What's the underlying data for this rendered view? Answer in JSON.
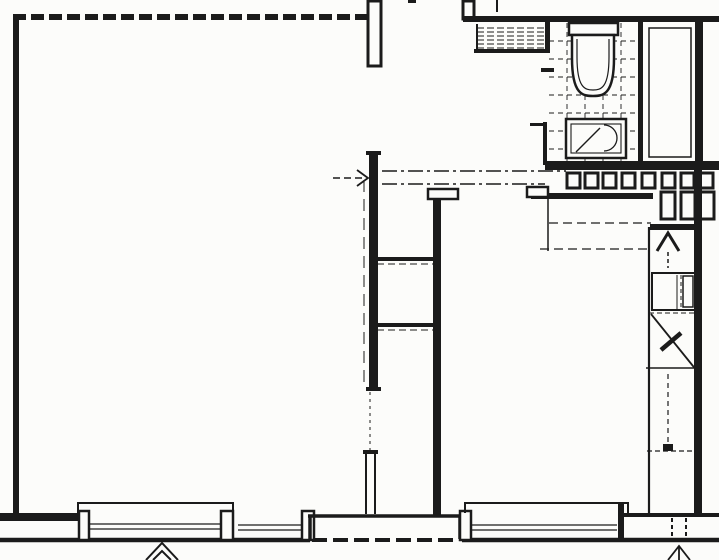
{
  "meta": {
    "width": 719,
    "height": 560,
    "kind": "architectural-floor-plan"
  },
  "colors": {
    "ink": "#1b1b1b",
    "paper": "#fcfcfa"
  },
  "floorplan": {
    "primitives": [
      {
        "name": "bathroom-tile-floor",
        "kind": "grid",
        "x": 549,
        "y": 23,
        "w": 89,
        "h": 141,
        "cell": 18,
        "sw": 0.9,
        "dash": [
          5,
          4
        ]
      },
      {
        "name": "vent-hatch-band",
        "kind": "hatch",
        "x": 477,
        "y": 24,
        "w": 70,
        "h": 27,
        "step": 4,
        "sw": 1.1,
        "dash": [
          7,
          3
        ]
      },
      {
        "name": "vent-hatch-bottom-wall",
        "kind": "line",
        "x1": 474,
        "y1": 51,
        "x2": 550,
        "y2": 51,
        "sw": 4
      },
      {
        "name": "vent-hatch-left-edge",
        "kind": "line",
        "x1": 477,
        "y1": 24,
        "x2": 477,
        "y2": 51,
        "sw": 2
      },
      {
        "name": "wall-left-outer",
        "kind": "rect",
        "x": 13,
        "y": 14,
        "w": 6,
        "h": 501
      },
      {
        "name": "wall-top-main-room",
        "kind": "line",
        "x1": 13,
        "y1": 17,
        "x2": 368,
        "y2": 17,
        "sw": 6,
        "dash": [
          13,
          5
        ]
      },
      {
        "name": "chimney-recess-left",
        "kind": "box",
        "x": 368,
        "y": 1,
        "w": 13,
        "h": 65,
        "sw": 3
      },
      {
        "name": "chimney-stub-right",
        "kind": "box",
        "x": 463,
        "y": 1,
        "w": 11,
        "h": 18,
        "sw": 3
      },
      {
        "name": "wall-top-right",
        "kind": "rect",
        "x": 463,
        "y": 16,
        "w": 256,
        "h": 6
      },
      {
        "name": "top-edge-tick",
        "kind": "rect",
        "x": 408,
        "y": 0,
        "w": 8,
        "h": 3
      },
      {
        "name": "hatch-top-tick",
        "kind": "line",
        "x1": 497,
        "y1": 0,
        "x2": 497,
        "y2": 12,
        "sw": 2
      },
      {
        "name": "bathroom-wall-left-upper",
        "kind": "rect",
        "x": 545,
        "y": 22,
        "w": 5,
        "h": 29
      },
      {
        "name": "bathroom-door-jamb",
        "kind": "rect",
        "x": 541,
        "y": 68,
        "w": 13,
        "h": 4
      },
      {
        "name": "bathroom-wall-left-lower",
        "kind": "rect",
        "x": 543,
        "y": 122,
        "w": 4,
        "h": 43
      },
      {
        "name": "bathroom-wall-tick",
        "kind": "rect",
        "x": 530,
        "y": 123,
        "w": 14,
        "h": 3
      },
      {
        "name": "wall-bath-shaft-divider",
        "kind": "rect",
        "x": 638,
        "y": 22,
        "w": 5,
        "h": 143
      },
      {
        "name": "wall-right-outer-upper",
        "kind": "rect",
        "x": 695,
        "y": 20,
        "w": 8,
        "h": 145
      },
      {
        "name": "shaft-inner-liner",
        "kind": "box",
        "x": 649,
        "y": 28,
        "w": 42,
        "h": 129,
        "sw": 1.5
      },
      {
        "name": "wall-below-bathroom",
        "kind": "rect",
        "x": 545,
        "y": 161,
        "w": 174,
        "h": 9
      },
      {
        "name": "toilet-tank",
        "kind": "box",
        "x": 569,
        "y": 23,
        "w": 49,
        "h": 12,
        "sw": 2.5,
        "fill": true
      },
      {
        "name": "toilet-bowl-outer",
        "kind": "path",
        "d": "M572,35 L572,58 C572,95 583,96 593,96 C603,96 614,95 614,58 L614,35 Z",
        "sw": 2.5,
        "fill": true
      },
      {
        "name": "toilet-bowl-inner",
        "kind": "path",
        "d": "M577,39 L577,57 C577,88 585,90 593,90 C601,90 609,88 609,57 L609,39",
        "sw": 1.2
      },
      {
        "name": "sink-outline",
        "kind": "box",
        "x": 566,
        "y": 119,
        "w": 60,
        "h": 39,
        "sw": 2.5,
        "fill": true
      },
      {
        "name": "sink-inner-rim",
        "kind": "box",
        "x": 571,
        "y": 124,
        "w": 50,
        "h": 29,
        "sw": 1.1
      },
      {
        "name": "sink-basin-arc",
        "kind": "path",
        "d": "M604,125 A13,13 0 0 1 604,151",
        "sw": 1.3
      },
      {
        "name": "sink-drain-diagonal",
        "kind": "line",
        "x1": 576,
        "y1": 152,
        "x2": 600,
        "y2": 128,
        "sw": 1.4
      },
      {
        "name": "radiator-segment",
        "kind": "box",
        "x": 567,
        "y": 173,
        "w": 13,
        "h": 15,
        "sw": 3
      },
      {
        "name": "radiator-segment",
        "kind": "box",
        "x": 585,
        "y": 173,
        "w": 13,
        "h": 15,
        "sw": 3
      },
      {
        "name": "radiator-segment",
        "kind": "box",
        "x": 603,
        "y": 173,
        "w": 13,
        "h": 15,
        "sw": 3
      },
      {
        "name": "radiator-segment",
        "kind": "box",
        "x": 622,
        "y": 173,
        "w": 13,
        "h": 15,
        "sw": 3
      },
      {
        "name": "radiator-segment",
        "kind": "box",
        "x": 642,
        "y": 173,
        "w": 13,
        "h": 15,
        "sw": 3
      },
      {
        "name": "radiator-segment",
        "kind": "box",
        "x": 662,
        "y": 173,
        "w": 13,
        "h": 15,
        "sw": 3
      },
      {
        "name": "radiator-segment",
        "kind": "box",
        "x": 681,
        "y": 173,
        "w": 13,
        "h": 15,
        "sw": 3
      },
      {
        "name": "radiator-segment",
        "kind": "box",
        "x": 700,
        "y": 173,
        "w": 13,
        "h": 15,
        "sw": 3
      },
      {
        "name": "radiator-vertical-segment",
        "kind": "box",
        "x": 661,
        "y": 192,
        "w": 14,
        "h": 27,
        "sw": 3
      },
      {
        "name": "radiator-vertical-segment",
        "kind": "box",
        "x": 681,
        "y": 192,
        "w": 14,
        "h": 27,
        "sw": 3
      },
      {
        "name": "radiator-vertical-segment",
        "kind": "box",
        "x": 700,
        "y": 192,
        "w": 14,
        "h": 27,
        "sw": 3
      },
      {
        "name": "wall-room2-top",
        "kind": "rect",
        "x": 531,
        "y": 193,
        "w": 122,
        "h": 6
      },
      {
        "name": "door-jamb-bar-room2",
        "kind": "box",
        "x": 527,
        "y": 187,
        "w": 21,
        "h": 10,
        "sw": 2.5,
        "fill": true
      },
      {
        "name": "wall-stub-room2",
        "kind": "line",
        "x1": 548,
        "y1": 199,
        "x2": 548,
        "y2": 251,
        "sw": 1.5
      },
      {
        "name": "wardrobe-dash-upper",
        "kind": "line",
        "x1": 549,
        "y1": 223,
        "x2": 651,
        "y2": 223,
        "sw": 1.2,
        "dash": [
          9,
          5
        ]
      },
      {
        "name": "wardrobe-dash-lower",
        "kind": "line",
        "x1": 540,
        "y1": 249,
        "x2": 651,
        "y2": 249,
        "sw": 1.2,
        "dash": [
          9,
          5
        ]
      },
      {
        "name": "wall-kitchen-top",
        "kind": "rect",
        "x": 650,
        "y": 224,
        "w": 46,
        "h": 6
      },
      {
        "name": "wall-kitchen-left",
        "kind": "line",
        "x1": 649,
        "y1": 227,
        "x2": 649,
        "y2": 515,
        "sw": 2.2
      },
      {
        "name": "wall-right-outer-lower",
        "kind": "rect",
        "x": 694,
        "y": 165,
        "w": 8,
        "h": 351
      },
      {
        "name": "kitchen-entry-arrow-head",
        "kind": "path",
        "d": "M657,251 L668,233 L679,251",
        "sw": 3
      },
      {
        "name": "kitchen-entry-arrow-stem",
        "kind": "line",
        "x1": 668,
        "y1": 252,
        "x2": 668,
        "y2": 268,
        "sw": 1.5,
        "dash": [
          4,
          3
        ]
      },
      {
        "name": "kitchen-cabinet",
        "kind": "box",
        "x": 652,
        "y": 273,
        "w": 43,
        "h": 37,
        "sw": 2
      },
      {
        "name": "kitchen-cabinet-divider",
        "kind": "line",
        "x1": 677,
        "y1": 275,
        "x2": 677,
        "y2": 309,
        "sw": 1
      },
      {
        "name": "kitchen-cabinet-divider-dash",
        "kind": "line",
        "x1": 681,
        "y1": 275,
        "x2": 681,
        "y2": 309,
        "sw": 1,
        "dash": [
          4,
          3
        ]
      },
      {
        "name": "kitchen-cabinet-inner",
        "kind": "box",
        "x": 683,
        "y": 276,
        "w": 10,
        "h": 31,
        "sw": 1.5
      },
      {
        "name": "kitchen-dash-under-cabinet",
        "kind": "line",
        "x1": 649,
        "y1": 313,
        "x2": 695,
        "y2": 313,
        "sw": 1,
        "dash": [
          5,
          3
        ]
      },
      {
        "name": "kitchen-door-swing-diagonal",
        "kind": "line",
        "x1": 651,
        "y1": 314,
        "x2": 697,
        "y2": 371,
        "sw": 1.8
      },
      {
        "name": "kitchen-door-leaf",
        "kind": "line",
        "x1": 681,
        "y1": 333,
        "x2": 661,
        "y2": 350,
        "sw": 4.5
      },
      {
        "name": "kitchen-counter-line",
        "kind": "line",
        "x1": 646,
        "y1": 368,
        "x2": 699,
        "y2": 368,
        "sw": 1.5
      },
      {
        "name": "kitchen-dash-vertical",
        "kind": "line",
        "x1": 668,
        "y1": 374,
        "x2": 668,
        "y2": 448,
        "sw": 1.2,
        "dash": [
          5,
          4
        ]
      },
      {
        "name": "kitchen-dash-horizontal",
        "kind": "line",
        "x1": 647,
        "y1": 451,
        "x2": 696,
        "y2": 451,
        "sw": 1.2,
        "dash": [
          5,
          3
        ]
      },
      {
        "name": "kitchen-floor-mark",
        "kind": "rect",
        "x": 663,
        "y": 444,
        "w": 10,
        "h": 7
      },
      {
        "name": "wall-mid-upper",
        "kind": "rect",
        "x": 369,
        "y": 151,
        "w": 9,
        "h": 240
      },
      {
        "name": "wall-mid-cap-top",
        "kind": "rect",
        "x": 366,
        "y": 151,
        "w": 15,
        "h": 4
      },
      {
        "name": "wall-mid-cap-bottom",
        "kind": "rect",
        "x": 366,
        "y": 387,
        "w": 15,
        "h": 4
      },
      {
        "name": "wall-mid-outer-face",
        "kind": "line",
        "x1": 364,
        "y1": 180,
        "x2": 364,
        "y2": 388,
        "sw": 1,
        "dash": [
          12,
          7
        ]
      },
      {
        "name": "doorway-threshold-line",
        "kind": "line",
        "x1": 370,
        "y1": 392,
        "x2": 370,
        "y2": 450,
        "sw": 1,
        "dash": [
          3,
          4
        ]
      },
      {
        "name": "wall-mid-lower-face-a",
        "kind": "line",
        "x1": 366,
        "y1": 452,
        "x2": 366,
        "y2": 514,
        "sw": 2
      },
      {
        "name": "wall-mid-lower-face-b",
        "kind": "line",
        "x1": 375,
        "y1": 452,
        "x2": 375,
        "y2": 514,
        "sw": 2
      },
      {
        "name": "wall-mid-lower-cap",
        "kind": "rect",
        "x": 363,
        "y": 450,
        "w": 15,
        "h": 4
      },
      {
        "name": "door-jamb-bar-mid",
        "kind": "box",
        "x": 428,
        "y": 189,
        "w": 30,
        "h": 10,
        "sw": 2.5,
        "fill": true
      },
      {
        "name": "wall-mid-second",
        "kind": "rect",
        "x": 433,
        "y": 199,
        "w": 8,
        "h": 317
      },
      {
        "name": "closet-divider-upper",
        "kind": "rect",
        "x": 377,
        "y": 257,
        "w": 56,
        "h": 4
      },
      {
        "name": "closet-divider-upper-dash",
        "kind": "line",
        "x1": 377,
        "y1": 264,
        "x2": 433,
        "y2": 264,
        "sw": 1,
        "dash": [
          7,
          4
        ]
      },
      {
        "name": "closet-divider-lower",
        "kind": "rect",
        "x": 377,
        "y": 323,
        "w": 56,
        "h": 4
      },
      {
        "name": "closet-divider-lower-dash",
        "kind": "line",
        "x1": 377,
        "y1": 330,
        "x2": 433,
        "y2": 330,
        "sw": 1,
        "dash": [
          7,
          4
        ]
      },
      {
        "name": "entry-arrow-shaft",
        "kind": "line",
        "x1": 333,
        "y1": 178,
        "x2": 365,
        "y2": 178,
        "sw": 1.6,
        "dash": [
          7,
          4
        ]
      },
      {
        "name": "entry-arrow-head",
        "kind": "path",
        "d": "M357,170 L368,178 L357,186",
        "sw": 1.8
      },
      {
        "name": "section-line-upper",
        "kind": "line",
        "x1": 382,
        "y1": 171,
        "x2": 566,
        "y2": 171,
        "sw": 1.5,
        "dash": [
          15,
          4,
          3,
          4
        ]
      },
      {
        "name": "section-line-lower",
        "kind": "line",
        "x1": 382,
        "y1": 184,
        "x2": 545,
        "y2": 184,
        "sw": 1.5,
        "dash": [
          15,
          4,
          3,
          4
        ]
      },
      {
        "name": "baseline-left",
        "kind": "line",
        "x1": 0,
        "y1": 540,
        "x2": 310,
        "y2": 540,
        "sw": 4.5
      },
      {
        "name": "baseline-threshold-dashed",
        "kind": "line",
        "x1": 312,
        "y1": 540,
        "x2": 459,
        "y2": 540,
        "sw": 4,
        "dash": [
          15,
          6
        ]
      },
      {
        "name": "baseline-right",
        "kind": "line",
        "x1": 462,
        "y1": 540,
        "x2": 719,
        "y2": 540,
        "sw": 4.5
      },
      {
        "name": "sill-wall-left",
        "kind": "rect",
        "x": 0,
        "y": 513,
        "w": 80,
        "h": 8
      },
      {
        "name": "window1-pier-left",
        "kind": "box",
        "x": 79,
        "y": 511,
        "w": 10,
        "h": 29,
        "sw": 2.5,
        "fill": true
      },
      {
        "name": "window1-pier-right",
        "kind": "box",
        "x": 221,
        "y": 511,
        "w": 12,
        "h": 29,
        "sw": 2.5,
        "fill": true
      },
      {
        "name": "window1-frame-top",
        "kind": "line",
        "x1": 77,
        "y1": 503,
        "x2": 234,
        "y2": 503,
        "sw": 2
      },
      {
        "name": "window1-frame-tick-left",
        "kind": "line",
        "x1": 78,
        "y1": 503,
        "x2": 78,
        "y2": 513,
        "sw": 2
      },
      {
        "name": "window1-frame-tick-right",
        "kind": "line",
        "x1": 233,
        "y1": 503,
        "x2": 233,
        "y2": 513,
        "sw": 2
      },
      {
        "name": "window1-glazing",
        "kind": "line",
        "x1": 89,
        "y1": 524,
        "x2": 221,
        "y2": 524,
        "sw": 1.2
      },
      {
        "name": "window1-glazing",
        "kind": "line",
        "x1": 89,
        "y1": 529,
        "x2": 221,
        "y2": 529,
        "sw": 1.2
      },
      {
        "name": "window2-glazing",
        "kind": "line",
        "x1": 238,
        "y1": 525,
        "x2": 303,
        "y2": 525,
        "sw": 1.2
      },
      {
        "name": "window2-glazing",
        "kind": "line",
        "x1": 238,
        "y1": 530,
        "x2": 303,
        "y2": 530,
        "sw": 1.2
      },
      {
        "name": "window2-pier-right",
        "kind": "box",
        "x": 302,
        "y": 511,
        "w": 12,
        "h": 29,
        "sw": 2.5,
        "fill": true
      },
      {
        "name": "balcony-threshold-top",
        "kind": "line",
        "x1": 308,
        "y1": 516,
        "x2": 462,
        "y2": 516,
        "sw": 3.5
      },
      {
        "name": "balcony-threshold-left",
        "kind": "line",
        "x1": 310,
        "y1": 516,
        "x2": 310,
        "y2": 539,
        "sw": 3.5
      },
      {
        "name": "balcony-threshold-right",
        "kind": "line",
        "x1": 460,
        "y1": 516,
        "x2": 460,
        "y2": 539,
        "sw": 3.5
      },
      {
        "name": "window3-pier-left",
        "kind": "box",
        "x": 460,
        "y": 511,
        "w": 11,
        "h": 29,
        "sw": 2.5,
        "fill": true
      },
      {
        "name": "window3-frame-top",
        "kind": "line",
        "x1": 464,
        "y1": 503,
        "x2": 629,
        "y2": 503,
        "sw": 2
      },
      {
        "name": "window3-frame-tick-left",
        "kind": "line",
        "x1": 465,
        "y1": 503,
        "x2": 465,
        "y2": 513,
        "sw": 2
      },
      {
        "name": "window3-frame-tick-right",
        "kind": "line",
        "x1": 628,
        "y1": 503,
        "x2": 628,
        "y2": 513,
        "sw": 2
      },
      {
        "name": "window3-glazing",
        "kind": "line",
        "x1": 471,
        "y1": 525,
        "x2": 617,
        "y2": 525,
        "sw": 1.2
      },
      {
        "name": "window3-glazing",
        "kind": "line",
        "x1": 471,
        "y1": 530,
        "x2": 617,
        "y2": 530,
        "sw": 1.2
      },
      {
        "name": "window3-pier-right",
        "kind": "rect",
        "x": 618,
        "y": 503,
        "w": 6,
        "h": 37
      },
      {
        "name": "entry-band-top",
        "kind": "line",
        "x1": 624,
        "y1": 515,
        "x2": 719,
        "y2": 515,
        "sw": 4
      },
      {
        "name": "entry-door-dash",
        "kind": "line",
        "x1": 672,
        "y1": 518,
        "x2": 672,
        "y2": 538,
        "sw": 2,
        "dash": [
          4,
          3
        ]
      },
      {
        "name": "entry-door-dash",
        "kind": "line",
        "x1": 686,
        "y1": 518,
        "x2": 686,
        "y2": 538,
        "sw": 2,
        "dash": [
          4,
          3
        ]
      },
      {
        "name": "arrow-bottom-left-outer",
        "kind": "path",
        "d": "M146,560 L162,543 L178,560",
        "sw": 2
      },
      {
        "name": "arrow-bottom-left-inner",
        "kind": "path",
        "d": "M153,560 L162,551 L171,560",
        "sw": 2
      },
      {
        "name": "arrow-bottom-right-head",
        "kind": "path",
        "d": "M668,560 L679,546 L690,560",
        "sw": 1.8
      },
      {
        "name": "arrow-bottom-right-stem",
        "kind": "line",
        "x1": 679,
        "y1": 547,
        "x2": 679,
        "y2": 560,
        "sw": 1.8
      }
    ]
  }
}
